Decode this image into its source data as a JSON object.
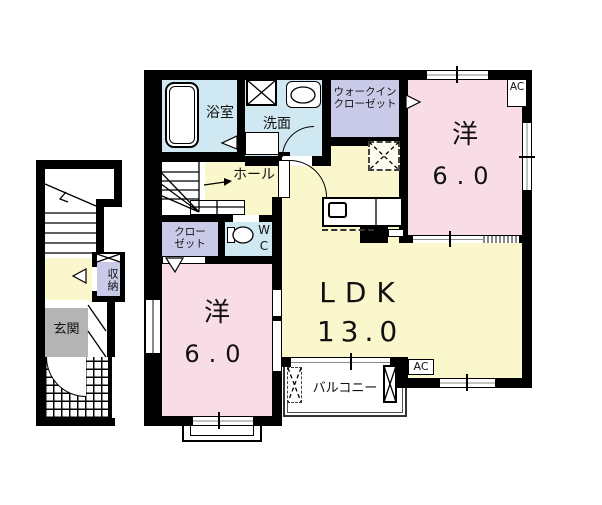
{
  "floorplan": {
    "rooms": {
      "bath": {
        "label": "浴室"
      },
      "washroom": {
        "label": "洗面"
      },
      "walk_in_closet": {
        "label": "ウォークイン\nクローゼット"
      },
      "bedroom_ne": {
        "label": "洋",
        "size": "6.0"
      },
      "hall": {
        "label": "ホール"
      },
      "closet": {
        "label": "クロー\nゼット"
      },
      "wc": {
        "label": "WC"
      },
      "ldk": {
        "label": "LDK",
        "size": "13.0"
      },
      "bedroom_sw": {
        "label": "洋",
        "size": "6.0"
      },
      "balcony": {
        "label": "バルコニー"
      },
      "entrance": {
        "label": "玄関"
      },
      "storage": {
        "label": "収納"
      }
    },
    "ac_units": {
      "upper": "AC",
      "lower": "AC"
    },
    "colors": {
      "wall": "#000000",
      "water_blue": "#cfe8f2",
      "closet_purple": "#c9cae8",
      "room_pink": "#f8dce6",
      "ldk_yellow": "#fbf7cc",
      "entrance_gray": "#b4b4b4"
    }
  }
}
